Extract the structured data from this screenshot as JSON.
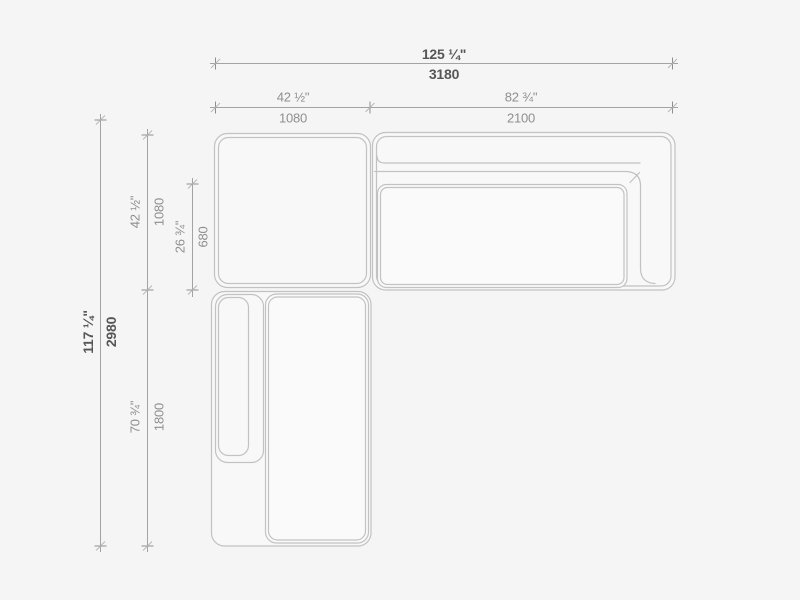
{
  "drawing": {
    "kind": "sectional sofa top view dimension drawing",
    "units": [
      "inches",
      "millimeters"
    ]
  },
  "dims": {
    "overall_width": {
      "in": "125 ¼\"",
      "mm": "3180"
    },
    "left_width": {
      "in": "42 ½\"",
      "mm": "1080"
    },
    "right_width": {
      "in": "82 ¾\"",
      "mm": "2100"
    },
    "overall_depth": {
      "in": "117 ¼\"",
      "mm": "2980"
    },
    "top_depth": {
      "in": "42 ½\"",
      "mm": "1080"
    },
    "seat_depth": {
      "in": "26 ¾\"",
      "mm": "680"
    },
    "chaise_depth": {
      "in": "70 ¾\"",
      "mm": "1800"
    }
  },
  "colors": {
    "background": "#f5f5f5",
    "dimension_line": "#a3a3a3",
    "furniture_outline": "#c2c2c2",
    "text_primary": "#565656",
    "text_secondary": "#8f8f8f"
  }
}
